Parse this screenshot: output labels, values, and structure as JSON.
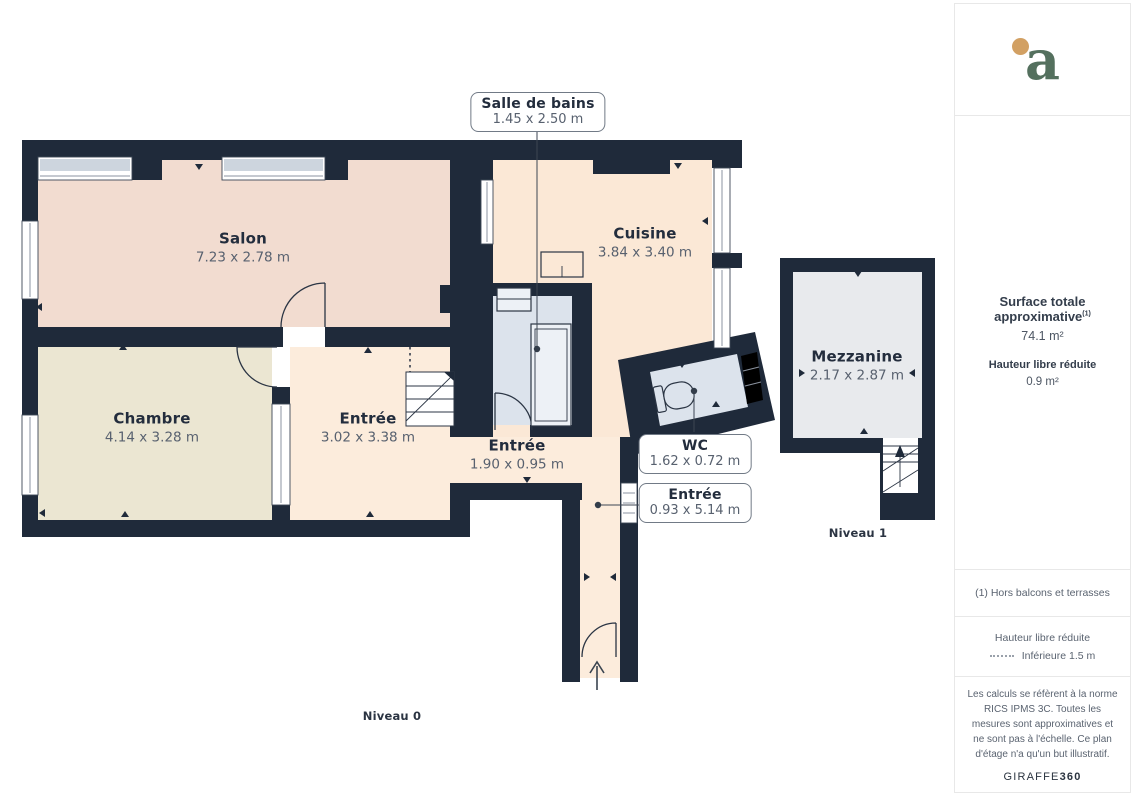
{
  "plan": {
    "level0": {
      "label": "Niveau 0",
      "rooms": {
        "salon": {
          "name": "Salon",
          "dims": "7.23 x 2.78 m"
        },
        "chambre": {
          "name": "Chambre",
          "dims": "4.14 x 3.28 m"
        },
        "entree": {
          "name": "Entrée",
          "dims": "3.02 x 3.38 m"
        },
        "entree_small": {
          "name": "Entrée",
          "dims": "1.90 x 0.95 m"
        },
        "cuisine": {
          "name": "Cuisine",
          "dims": "3.84 x 3.40 m"
        }
      },
      "callouts": {
        "salle_de_bains": {
          "name": "Salle de bains",
          "dims": "1.45 x 2.50 m"
        },
        "wc": {
          "name": "WC",
          "dims": "1.62 x 0.72 m"
        },
        "entree_corridor": {
          "name": "Entrée",
          "dims": "0.93 x 5.14 m"
        }
      }
    },
    "level1": {
      "label": "Niveau 1",
      "rooms": {
        "mezzanine": {
          "name": "Mezzanine",
          "dims": "2.17 x 2.87 m"
        }
      }
    }
  },
  "sidebar": {
    "logo_letter": "a",
    "surface": {
      "title": "Surface totale approximative",
      "sup": "(1)",
      "value": "74.1 m²"
    },
    "reduced_height": {
      "title": "Hauteur libre réduite",
      "value": "0.9 m²"
    },
    "footnote": "(1) Hors balcons et terrasses",
    "legend": {
      "title": "Hauteur libre réduite",
      "value": "Inférieure 1.5 m"
    },
    "disclaimer": "Les calculs se réfèrent à la norme RICS IPMS 3C. Toutes les mesures sont approximatives et ne sont pas à l'échelle. Ce plan d'étage n'a qu'un but illustratif.",
    "brand": {
      "prefix": "GIRAFFE",
      "suffix": "360"
    }
  },
  "colors": {
    "wall": "#1f2a3a",
    "salon": "#f2dcd0",
    "chambre": "#ebe6d2",
    "entree": "#fcecdc",
    "cuisine": "#fbe8d6",
    "wet_room": "#dce3ec",
    "mezzanine": "#e8eaed",
    "window_glass": "#cdd5de",
    "fixture_fill": "#edf1f6",
    "logo_green": "#54705e",
    "logo_dot": "#d2a063"
  }
}
